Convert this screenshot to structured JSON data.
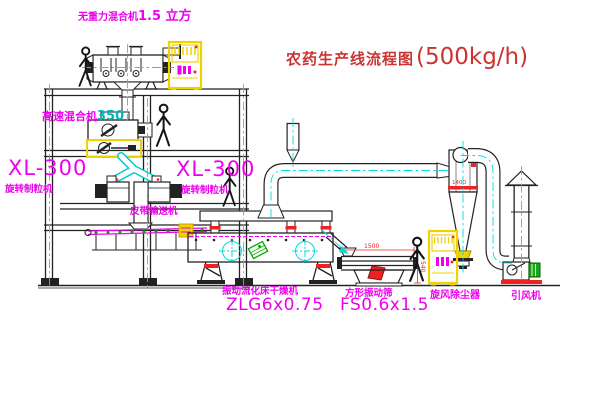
{
  "title": {
    "main": "农药生产线流程图",
    "capacity": "(500kg/h)"
  },
  "equipment": {
    "gravity_mixer": {
      "name": "无重力混合机",
      "size": "1.5 立方"
    },
    "high_speed_mixer": {
      "name": "高速混合机",
      "model": "350"
    },
    "granulator_left": {
      "model": "XL-300",
      "name": "旋转制粒机"
    },
    "granulator_right": {
      "model": "XL-300",
      "name": "旋转制粒机"
    },
    "belt_conveyor": {
      "name": "皮带输送机"
    },
    "fluid_bed_dryer": {
      "name": "振动流化床干燥机",
      "model": "ZLG6x0.75"
    },
    "vibrating_sieve": {
      "name": "方形振动筛",
      "model": "FS0.6x1.5"
    },
    "cyclone": {
      "name": "旋风除尘器"
    },
    "induced_draft_fan": {
      "name": "引风机"
    }
  },
  "dimensions": {
    "sieve_length": "1500",
    "sieve_height": "540",
    "cyclone_dia": "1400"
  },
  "colors": {
    "label_magenta": "#ee00ee",
    "title_red": "#cc3333",
    "centerline_cyan": "#00dddd",
    "highlight_yellow": "#f0d200",
    "accent_green": "#00a000",
    "dim_red": "#ee2222",
    "line_black": "#222222"
  }
}
